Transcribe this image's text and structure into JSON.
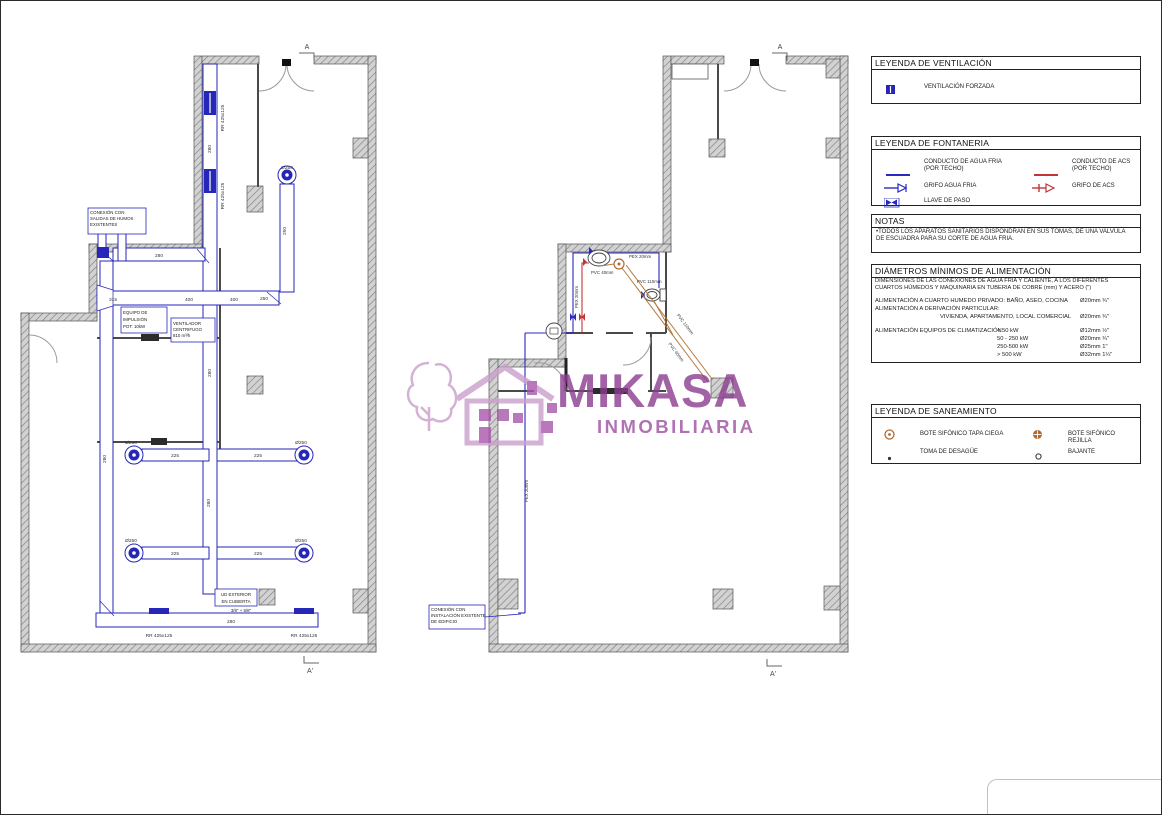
{
  "watermark": {
    "brand": "MIKASA",
    "tagline": "INMOBILIARIA",
    "color": "#8c3d90"
  },
  "markers": {
    "top": "A",
    "bottom": "A'"
  },
  "plan_left": {
    "callout_humos": [
      "CONEXIÓN CON",
      "SALIDAS DE HUMOS",
      "EXISTENTES"
    ],
    "equipo": [
      "EQUIPO DE",
      "IMPULSIÓN",
      "POT: 10kW"
    ],
    "ventilador": [
      "VENTILADOR",
      "CENTRIFUGO",
      "810 m³/h"
    ],
    "ud_exterior": [
      "UD EXTERIOR",
      "EN CUBIERTA"
    ],
    "refrig": "3/8\" + 5/8\"",
    "grille": "RR 425x125",
    "dia": "Ø250",
    "d280": "280",
    "d225": "225",
    "d400": "400",
    "d250": "250",
    "d315": "315"
  },
  "plan_right": {
    "callout_conexion": [
      "CONEXIÓN CON",
      "INSTALACIÓN EXISTENTE",
      "DE EDIFICIO"
    ],
    "pvc40": "PVC 40mm",
    "pvc110": "PVC 110mm",
    "pex20": "PEX 20mm"
  },
  "legends": {
    "ventilacion": {
      "title": "LEYENDA DE VENTILACIÓN",
      "items": [
        {
          "icon": "forced-ventilation-grille",
          "label": "VENTILACIÓN FORZADA"
        }
      ]
    },
    "fontaneria": {
      "title": "LEYENDA DE FONTANERIA",
      "items": [
        {
          "icon": "cold-water-line",
          "label": "CONDUCTO DE AGUA FRIA",
          "sub": "(POR TECHO)"
        },
        {
          "icon": "hot-water-line",
          "label": "CONDUCTO DE ACS",
          "sub": "(POR TECHO)"
        },
        {
          "icon": "cold-water-tap",
          "label": "GRIFO AGUA FRIA"
        },
        {
          "icon": "hot-water-tap",
          "label": "GRIFO DE ACS"
        },
        {
          "icon": "shutoff-valve",
          "label": "LLAVE DE PASO"
        }
      ]
    },
    "notas": {
      "title": "NOTAS",
      "text": "•TODOS LOS APARATOS SANITARIOS DISPONDRAN EN SUS TOMAS, DE UNA VALVULA DE ESCUADRA PARA SU CORTE DE AGUA FRIA."
    },
    "diametros": {
      "title": "DIÁMETROS MÍNIMOS DE ALIMENTACIÓN",
      "subtitle": "DIMENSIONES DE LAS CONEXIONES DE AGUA FRIA Y CALIENTE, A LOS DIFERENTES CUARTOS HÚMEDOS Y MAQUINARIA EN TUBERIA DE COBRE (mm) Y ACERO (\")",
      "rows": [
        {
          "label": "ALIMENTACIÓN A CUARTO HUMEDO PRIVADO: BAÑO, ASEO, COCINA",
          "value": "Ø20mm ¾\""
        },
        {
          "label": "ALIMENTACIÓN A DERIVACIÓN PARTICULAR:",
          "value": ""
        },
        {
          "label": "VIVIENDA, APARTAMENTO, LOCAL COMERCIAL",
          "value": "Ø20mm ¾\""
        }
      ],
      "clim_label": "ALIMENTACIÓN EQUIPOS DE CLIMATIZACIÓN",
      "clim_rows": [
        {
          "range": "< 50 kW",
          "value": "Ø12mm ½\""
        },
        {
          "range": "50 - 250 kW",
          "value": "Ø20mm ¾\""
        },
        {
          "range": "250-500 kW",
          "value": "Ø25mm 1\""
        },
        {
          "range": "> 500 kW",
          "value": "Ø32mm 1¼\""
        }
      ]
    },
    "saneamiento": {
      "title": "LEYENDA DE SANEAMIENTO",
      "items": [
        {
          "icon": "siphon-box-blind-cover",
          "label": "BOTE SIFÓNICO TAPA CIEGA"
        },
        {
          "icon": "siphon-box-grille",
          "label": "BOTE SIFÓNICO REJILLA"
        },
        {
          "icon": "drain-outlet",
          "label": "TOMA DE DESAGÜE"
        },
        {
          "icon": "downpipe",
          "label": "BAJANTE"
        }
      ]
    }
  }
}
